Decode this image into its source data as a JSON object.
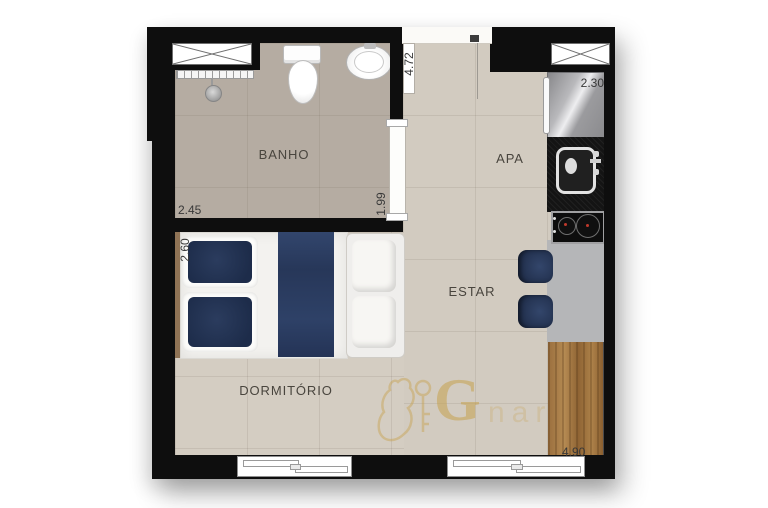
{
  "plan": {
    "rooms": [
      {
        "label": "BANHO"
      },
      {
        "label": "APA"
      },
      {
        "label": "ESTAR"
      },
      {
        "label": "DORMITÓRIO"
      }
    ],
    "dimensions": {
      "banho_width": "2.45",
      "banho_depth": "1.99",
      "hall_depth": "4.72",
      "kitchen_width": "2.30",
      "bed_width": "2.60",
      "living_width": "4.90"
    },
    "watermark": {
      "initial": "G",
      "suffix": "nar"
    },
    "colors": {
      "wall": "#0e0e0e",
      "floor_main": "#d2cbc0",
      "floor_bath": "#b5aca2",
      "navy": "#2c3e63",
      "wood": "#a57a45",
      "counter_black": "#141414",
      "counter_grey": "#b5b6b8",
      "gold": "#c7a24f"
    }
  }
}
